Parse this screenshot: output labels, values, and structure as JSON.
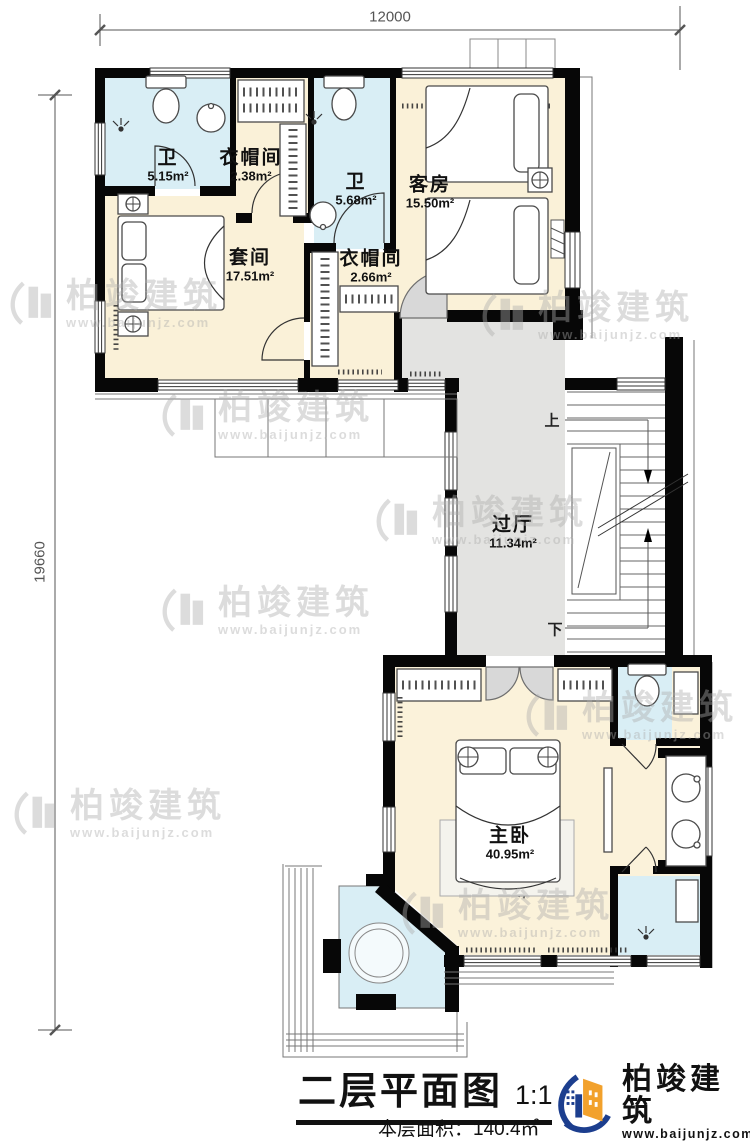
{
  "dimensions": {
    "top": "12000",
    "left": "19660"
  },
  "rooms": [
    {
      "name": "卫",
      "area": "5.15m²"
    },
    {
      "name": "衣帽间",
      "area": "2.38m²"
    },
    {
      "name": "卫",
      "area": "5.68m²"
    },
    {
      "name": "客房",
      "area": "15.50m²"
    },
    {
      "name": "套间",
      "area": "17.51m²"
    },
    {
      "name": "衣帽间",
      "area": "2.66m²"
    },
    {
      "name": "过厅",
      "area": "11.34m²"
    },
    {
      "name": "主卧",
      "area": "40.95m²"
    }
  ],
  "stairs": {
    "up": "上",
    "down": "下"
  },
  "footer": {
    "title": "二层平面图",
    "scale": "1:100",
    "floor_area": "本层面积：140.4㎡"
  },
  "logo": {
    "brand": "柏竣建筑",
    "website": "www.baijunjz.com"
  },
  "watermark": {
    "brand": "柏竣建筑",
    "website": "www.baijunjz.com"
  },
  "colors": {
    "wall": "#070707",
    "bedroom_fill": "#faf1d8",
    "bath_fill": "#d9eef5",
    "hall_fill": "#e3e3e1",
    "logo_blue": "#1c3e8e",
    "logo_orange": "#f2a12c"
  }
}
